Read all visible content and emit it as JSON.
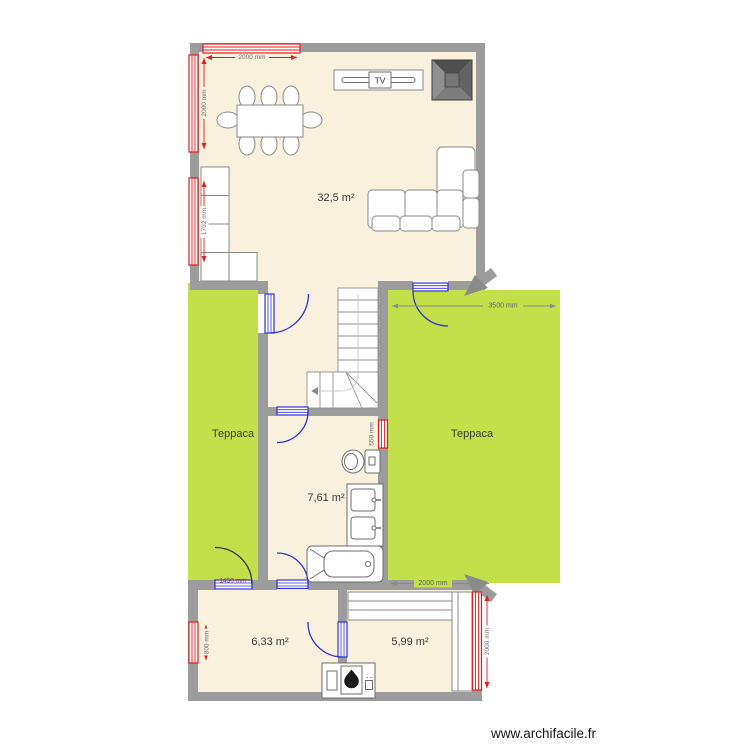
{
  "page": {
    "watermark": "www.archifacile.fr"
  },
  "rooms": {
    "living": {
      "area_label": "32,5 m²"
    },
    "bathroom": {
      "area_label": "7,61 m²"
    },
    "room_bottom_left": {
      "area_label": "6,33 m²"
    },
    "room_bottom_right": {
      "area_label": "5,99 m²"
    },
    "terrace_left": {
      "label": "Терраса"
    },
    "terrace_right": {
      "label": "Терраса"
    }
  },
  "furniture": {
    "tv_label": "TV"
  },
  "dimensions": {
    "window_top": "2000 mm",
    "window_left_upper": "2000 mm",
    "window_left_lower": "1792 mm",
    "window_bathroom": "550 mm",
    "window_bottom_left": "800 mm",
    "window_bottom_right": "2000 mm",
    "terrace_right_width": "3500 mm",
    "room_bottom_right_width": "2000 mm",
    "door_terrace_left_width": "1450 mm"
  },
  "colors": {
    "wall": "#9c9c9c",
    "floor": "#f7f1dd",
    "terrace": "#c3e04a",
    "window_red": "#e31b1b",
    "door_blue": "#3232d8",
    "dimension_gray": "#8a8a8a"
  }
}
